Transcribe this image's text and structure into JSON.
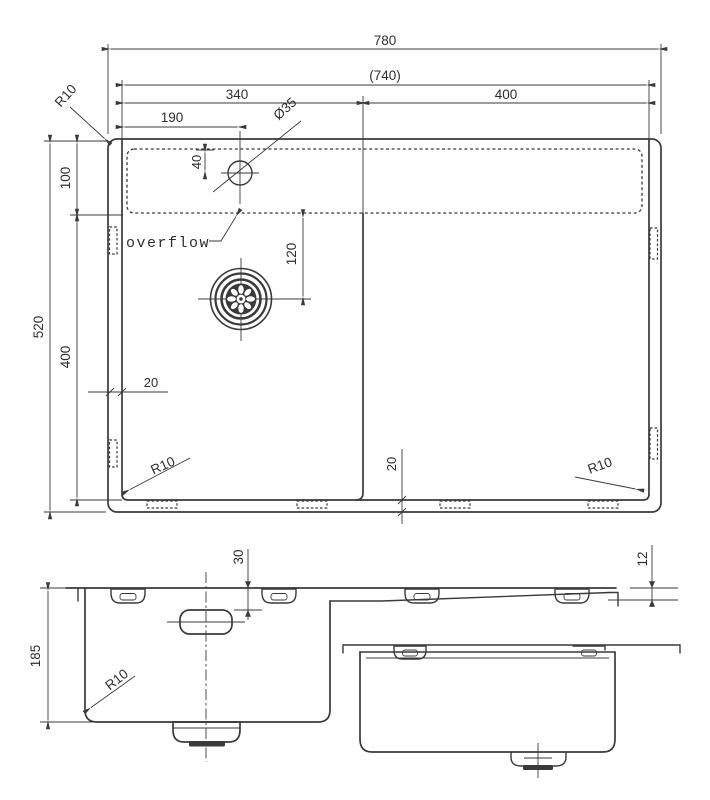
{
  "drawing": {
    "background_color": "#ffffff",
    "line_color": "#3a3a3a",
    "plan": {
      "dim_overall_width": "780",
      "dim_inner_width": "(740)",
      "dim_left_bowl_width": "340",
      "dim_right_bowl_width": "400",
      "dim_faucet_offset": "190",
      "dim_faucet_diameter": "Ø35",
      "dim_faucet_from_edge": "40",
      "dim_ledge_depth": "100",
      "dim_overall_depth": "520",
      "dim_bowl_depth": "400",
      "dim_drain_offset": "120",
      "dim_rim_left": "20",
      "dim_rim_bottom": "20",
      "radius_top_left": "R10",
      "radius_bottom_left": "R10",
      "radius_bottom_right": "R10",
      "overflow_label": "overflow"
    },
    "side": {
      "dim_bowl_height": "185",
      "dim_faucet_hole_depth": "30",
      "dim_edge_thickness": "12",
      "radius_bottom": "R10"
    }
  }
}
